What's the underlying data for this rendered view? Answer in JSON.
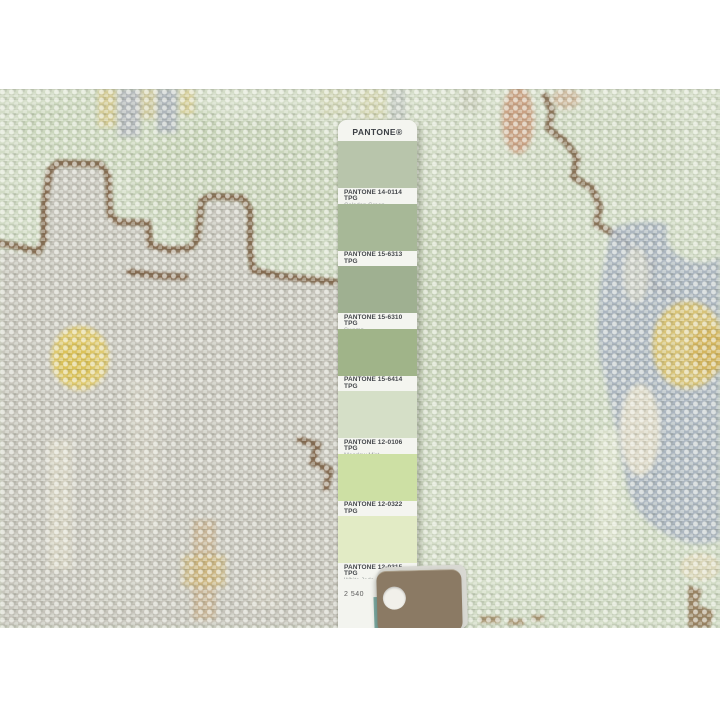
{
  "pantone_strip": {
    "brand": "PANTONE®",
    "page_number": "2 540",
    "swatches": [
      {
        "code": "PANTONE 14-0114 TPG",
        "name": "Celadon Green",
        "hex": "#b8c5ab"
      },
      {
        "code": "PANTONE 15-6313 TPG",
        "name": "Laurel Green",
        "hex": "#a7b897"
      },
      {
        "code": "PANTONE 15-6310 TPG",
        "name": "Swamp",
        "hex": "#9fb091"
      },
      {
        "code": "PANTONE 15-6414 TPG",
        "name": "Reseda",
        "hex": "#a0b489"
      },
      {
        "code": "PANTONE 12-0106 TPG",
        "name": "Meadow Mist",
        "hex": "#d5dfc7"
      },
      {
        "code": "PANTONE 12-0322 TPG",
        "name": "Butterfly",
        "hex": "#cde0a4"
      },
      {
        "code": "PANTONE 12-0315 TPG",
        "name": "White Jade",
        "hex": "#e2ebc5"
      }
    ]
  },
  "rug_palette": {
    "base": "#cdd8c1",
    "base2": "#d4ddc8",
    "motif": "#c6c4bb",
    "outline": "#7d6044",
    "yellow": "#e0ca6b",
    "tan": "#c9a183",
    "blue": "#a9b3c0",
    "holder": "#8b7a64"
  }
}
